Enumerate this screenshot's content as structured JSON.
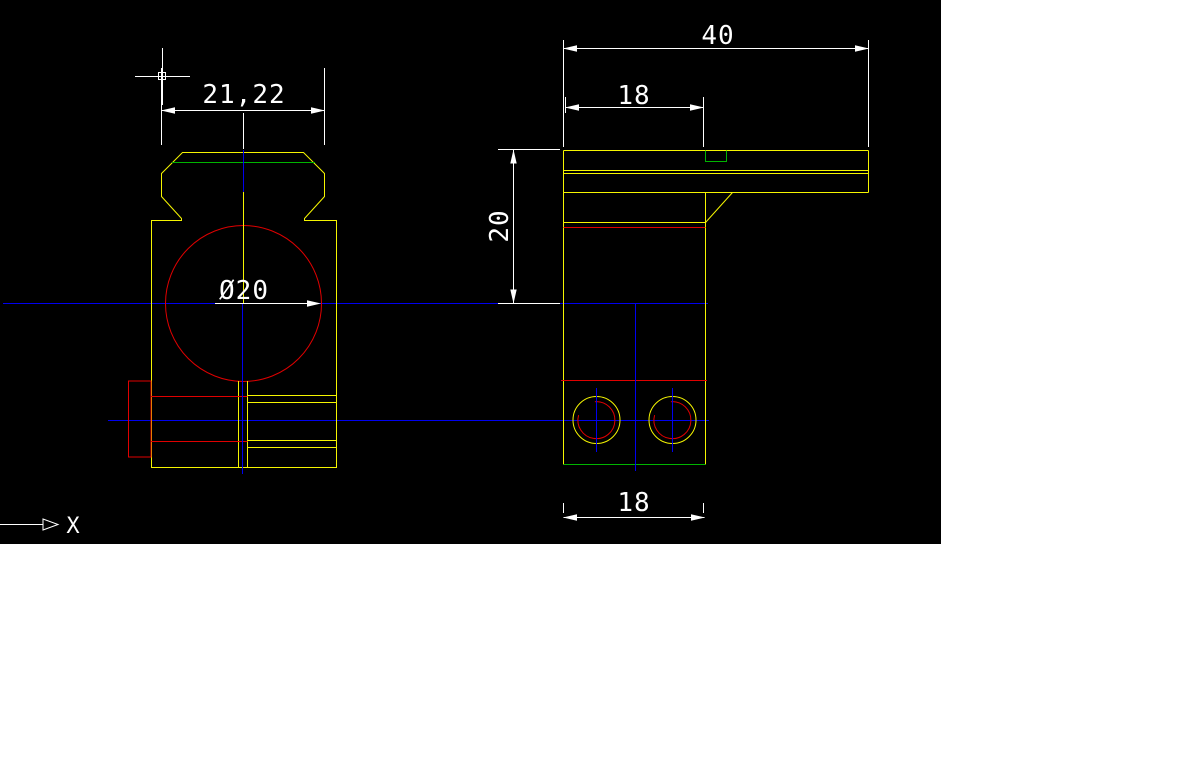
{
  "app": {
    "type": "cad-drawing-viewport"
  },
  "palette": {
    "viewport_background": "#000000",
    "page_background": "#ffffff",
    "part_outline": "#f5f500",
    "bore_and_section_lines": "#e00000",
    "machined_edge_lines": "#00b400",
    "centerlines": "#0000ee",
    "annotation_white": "#ffffff"
  },
  "viewport": {
    "width_px": 941,
    "height_px": 544
  },
  "annotations": {
    "front_view": {
      "width_dim": {
        "label": "21,22",
        "value": 21.22
      },
      "bore_dim": {
        "label": "Ø20",
        "value": 20
      }
    },
    "side_view": {
      "plate_length_dim": {
        "label": "40",
        "value": 40
      },
      "plate_inset_dim": {
        "label": "18",
        "value": 18
      },
      "height_dim": {
        "label": "20",
        "value": 20
      },
      "body_width_dim": {
        "label": "18",
        "value": 18
      }
    },
    "ucs": {
      "x_axis_label": "X"
    }
  }
}
